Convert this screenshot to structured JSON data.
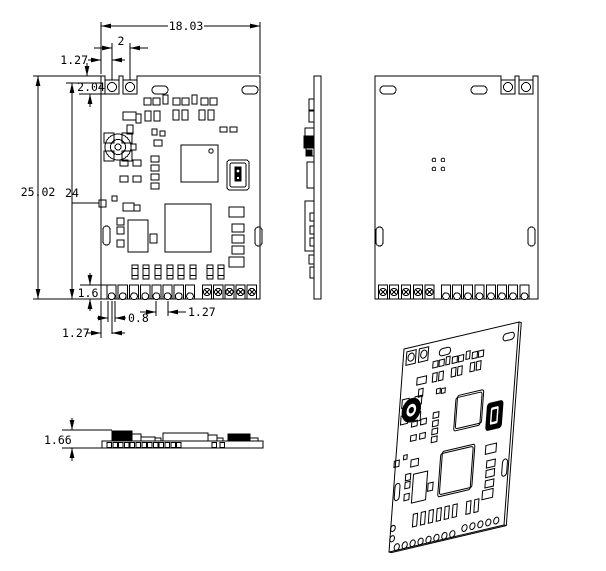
{
  "title": "PCB module dimensional drawing",
  "canvas": {
    "bg": "#ffffff",
    "line_color": "#000000"
  },
  "dimensions": {
    "board_width": "18.03",
    "hole_pitch": "2",
    "hole_offset": "1.27",
    "pad_depth": "2.04",
    "board_height": "25.02",
    "hole_to_bottom": "24",
    "pad_height": "1.6",
    "pin_pitch": "1.27",
    "pin_width": "0.8",
    "pin_offset": "1.27",
    "thickness": "1.66"
  }
}
